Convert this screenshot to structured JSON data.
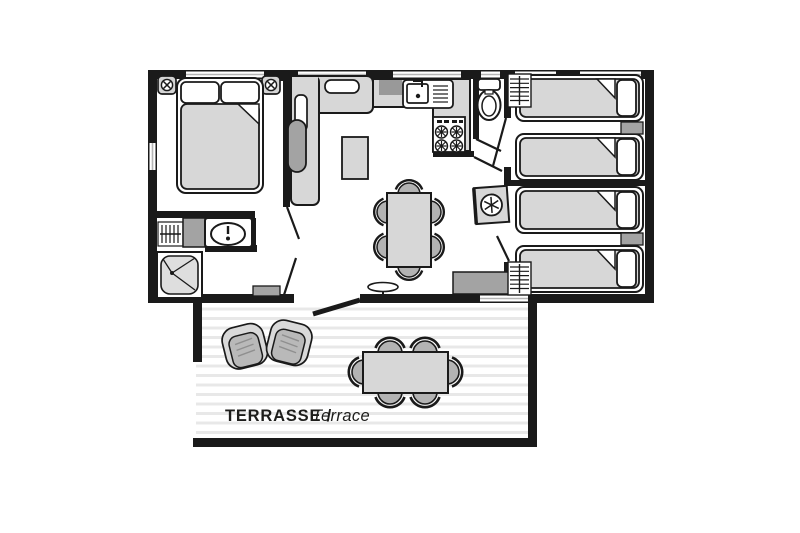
{
  "terrace": {
    "label_bold": "TERRASSE /",
    "label_italic": "Terrace"
  },
  "colors": {
    "wall": "#1a1a1a",
    "floor": "#ffffff",
    "furniture_gray": "#d7d7d7",
    "accent_gray": "#a3a3a3",
    "appliance_gray": "#999999",
    "chair_gray": "#b3b3b3",
    "armchair_band": "#d9d9d9",
    "armchair_seat": "#b9b9b9",
    "deck_stripe": "#e8e8e8",
    "window_line": "#b5b5b5",
    "text": "#1d1d1b"
  },
  "icons": [
    {
      "name": "double-bed-icon",
      "shape": "rounded-rect+2-pillows+fold-corner"
    },
    {
      "name": "single-bed-icon",
      "count": 4,
      "shape": "rounded-rect+pillow+fold-corner"
    },
    {
      "name": "ceiling-light-icon",
      "count": 2,
      "shape": "rounded-square+circle-cross"
    },
    {
      "name": "corner-sofa-icon",
      "shape": "L-rounded-rects+cushions"
    },
    {
      "name": "coffee-table-icon",
      "shape": "rect"
    },
    {
      "name": "dining-table-icon",
      "shape": "rect+6-semicircle-chairs"
    },
    {
      "name": "kitchen-sink-icon",
      "shape": "basin+faucet+drainboard-lines"
    },
    {
      "name": "stove-icon",
      "shape": "square+4-burners"
    },
    {
      "name": "refrigerator-icon",
      "shape": "square+snowflake-circle"
    },
    {
      "name": "toilet-icon",
      "shape": "tank+oval-bowl"
    },
    {
      "name": "washbasin-icon",
      "shape": "rounded-rect+oval-basin+tap"
    },
    {
      "name": "shower-icon",
      "shape": "square+drain-dot+bifold-lines"
    },
    {
      "name": "wardrobe-icon",
      "count": 3,
      "shape": "rect+rail+hanger-ticks"
    },
    {
      "name": "nightstand-icon",
      "count": 2,
      "shape": "gray-rect"
    },
    {
      "name": "sideboard-icon",
      "shape": "gray-rect"
    },
    {
      "name": "doormat-icon",
      "shape": "gray-rect"
    },
    {
      "name": "pedestal-table-icon",
      "shape": "ellipse+stem"
    },
    {
      "name": "armchair-icon",
      "count": 2,
      "shape": "rounded-band+seat-lines"
    },
    {
      "name": "terrace-table-icon",
      "shape": "rect+6-semicircle-chairs"
    },
    {
      "name": "door-leaf-icon",
      "count": 7,
      "shape": "diagonal-line"
    }
  ]
}
